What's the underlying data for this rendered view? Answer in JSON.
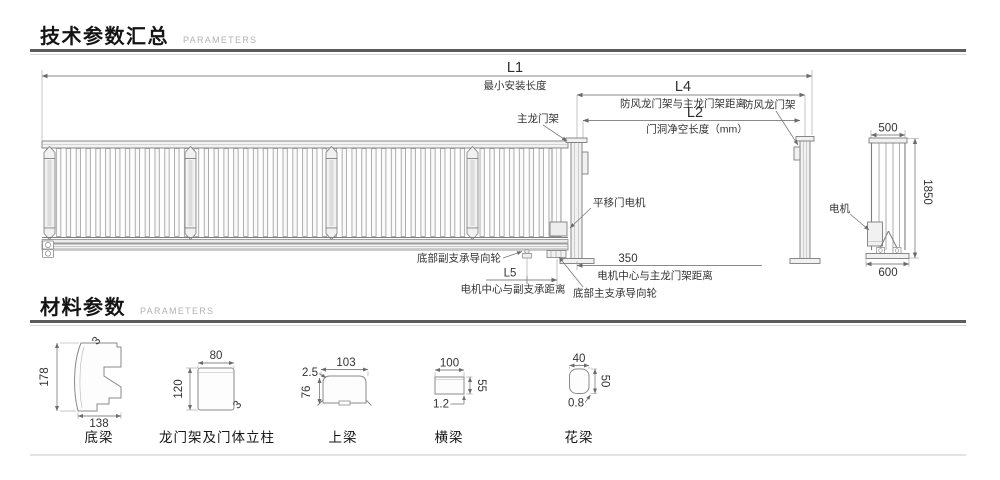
{
  "sections": {
    "technical": {
      "title": "技术参数汇总",
      "subtitle": "PARAMETERS"
    },
    "material": {
      "title": "材料参数",
      "subtitle": "PARAMETERS"
    }
  },
  "drawing": {
    "dims": {
      "L1": {
        "code": "L1",
        "desc": "最小安装长度"
      },
      "L4": {
        "code": "L4",
        "desc": "防风龙门架与主龙门架距离"
      },
      "L2": {
        "code": "L2",
        "desc": "门洞净空长度（mm）"
      },
      "L5": {
        "code": "L5",
        "desc": "电机中心与副支承距离"
      },
      "motor_to_gantry": {
        "code": "350",
        "desc": "电机中心与主龙门架距离"
      }
    },
    "labels": {
      "main_gantry": "主龙门架",
      "wind_gantry": "防风龙门架",
      "sliding_motor": "平移门电机",
      "aux_guide_wheel": "底部副支承导向轮",
      "main_guide_wheel": "底部主支承导向轮",
      "motor": "电机"
    },
    "side_view": {
      "top_width": "500",
      "height": "1850",
      "base_width": "600"
    }
  },
  "profiles": [
    {
      "name": "底梁",
      "width": "138",
      "height": "178",
      "thickness": "3"
    },
    {
      "name": "龙门架及门体立柱",
      "width": "80",
      "height": "120",
      "thickness": "3"
    },
    {
      "name": "上梁",
      "width": "103",
      "height": "76",
      "thickness": "2.5"
    },
    {
      "name": "横梁",
      "width": "100",
      "height": "55",
      "thickness": "1.2"
    },
    {
      "name": "花梁",
      "width": "40",
      "height": "50",
      "thickness": "0.8"
    }
  ],
  "colors": {
    "line": "#7d7d7d",
    "dim_line": "#8a8a8a",
    "text": "#333333",
    "divider_dark": "#5c5c5c",
    "divider_light": "#d6d6d6",
    "accent_fill": "#f1f1f1"
  }
}
